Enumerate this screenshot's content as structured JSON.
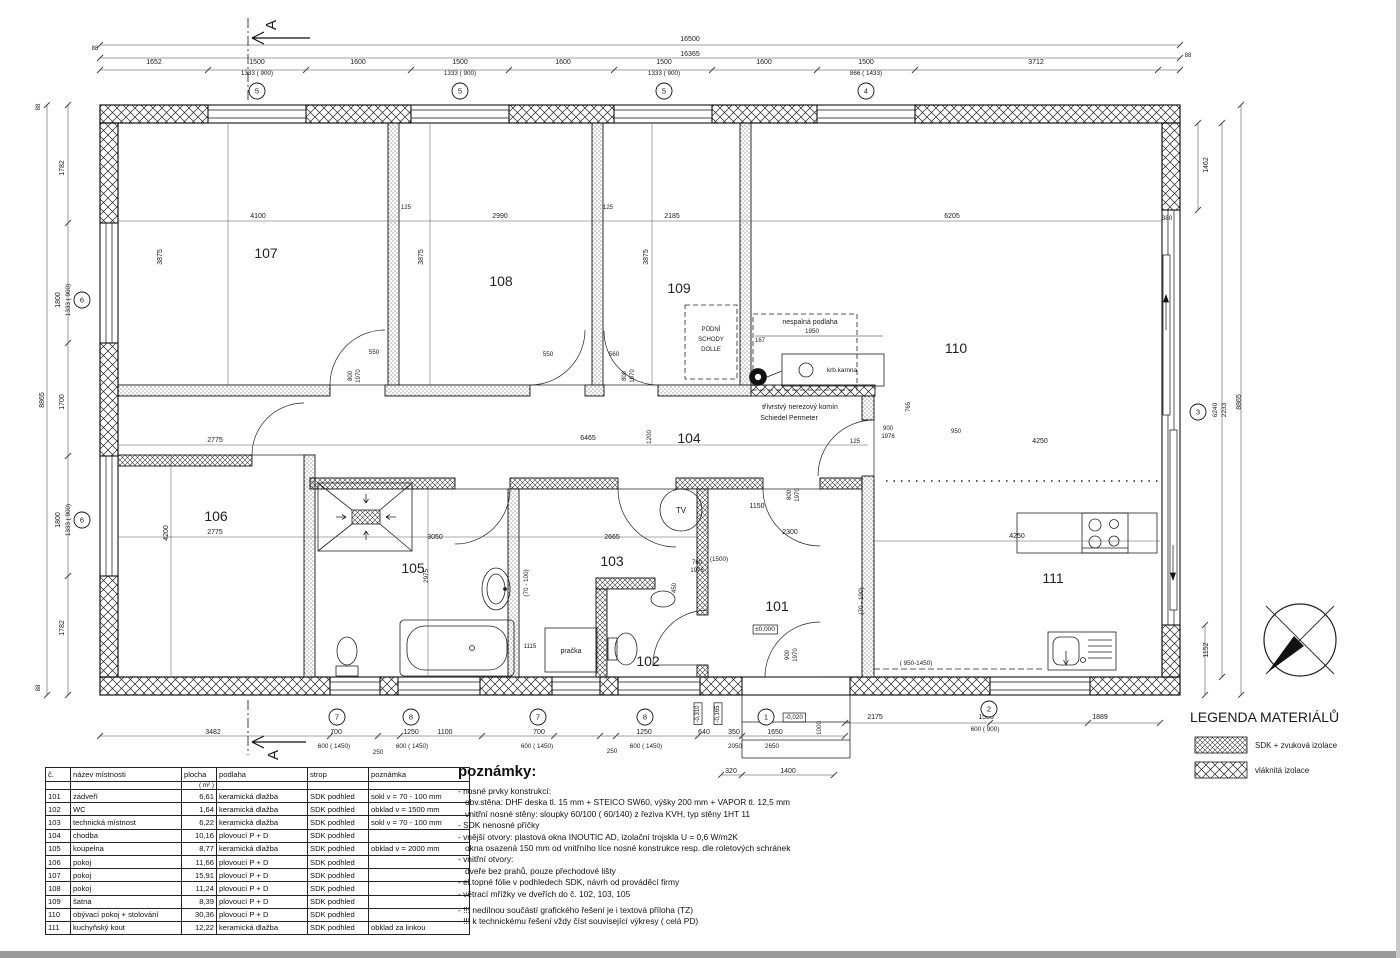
{
  "legend": {
    "title": "LEGENDA MATERIÁLŮ",
    "items": [
      {
        "label": "SDK + zvuková izolace"
      },
      {
        "label": "vláknitá izolace"
      }
    ]
  },
  "section_marker": "A",
  "room_table": {
    "headers": [
      "č.",
      "název místnosti",
      "plocha",
      "podlaha",
      "strop",
      "poznámka"
    ],
    "unit_row": [
      "",
      "",
      "( m² )",
      "",
      "",
      ""
    ],
    "rows": [
      [
        "101",
        "zádveří",
        "6,61",
        "keramická dlažba",
        "SDK podhled",
        "sokl v = 70 - 100 mm"
      ],
      [
        "102",
        "WC",
        "1,64",
        "keramická dlažba",
        "SDK podhled",
        "obklad v = 1500 mm"
      ],
      [
        "103",
        "technická místnost",
        "6,22",
        "keramická dlažba",
        "SDK podhled",
        "sokl v = 70 - 100 mm"
      ],
      [
        "104",
        "chodba",
        "10,16",
        "plovoucí P + D",
        "SDK podhled",
        ""
      ],
      [
        "105",
        "koupelna",
        "8,77",
        "keramická dlažba",
        "SDK podhled",
        "obklad v = 2000 mm"
      ],
      [
        "106",
        "pokoj",
        "11,66",
        "plovoucí P + D",
        "SDK podhled",
        ""
      ],
      [
        "107",
        "pokoj",
        "15,91",
        "plovoucí P + D",
        "SDK podhled",
        ""
      ],
      [
        "108",
        "pokoj",
        "11,24",
        "plovoucí P + D",
        "SDK podhled",
        ""
      ],
      [
        "109",
        "šatna",
        "8,39",
        "plovoucí P + D",
        "SDK podhled",
        ""
      ],
      [
        "110",
        "obývací pokoj + stolování",
        "30,36",
        "plovoucí P + D",
        "SDK podhled",
        ""
      ],
      [
        "111",
        "kuchyňský kout",
        "12,22",
        "keramická dlažba",
        "SDK podhled",
        "obklad za linkou"
      ]
    ]
  },
  "notes": {
    "heading": "poznámky:",
    "lines": [
      {
        "text": "- nosné prvky konstrukcí:",
        "indent": false,
        "gap": false
      },
      {
        "text": "obv.stěna: DHF deska tl. 15 mm + STEICO SW60, výšky 200 mm + VAPOR tl. 12,5 mm",
        "indent": true,
        "gap": false
      },
      {
        "text": "vnitřní nosné stěny: sloupky 60/100  ( 60/140)   z řeziva KVH, typ stěny 1HT 11",
        "indent": true,
        "gap": false
      },
      {
        "text": "- SDK nenosné příčky",
        "indent": false,
        "gap": false
      },
      {
        "text": "- vnější otvory:  plastová okna INOUTIC AD, izolační trojskla U = 0,6 W/m2K",
        "indent": false,
        "gap": false
      },
      {
        "text": "okna osazená 150 mm od vnitřního líce nosné konstrukce resp. dle  roletových schránek",
        "indent": true,
        "gap": false
      },
      {
        "text": "- vnitřní otvory:",
        "indent": false,
        "gap": false
      },
      {
        "text": "dveře bez prahů, pouze přechodové lišty",
        "indent": true,
        "gap": false
      },
      {
        "text": "- el.topné fólie v podhledech SDK, návrh od prováděcí firmy",
        "indent": false,
        "gap": false
      },
      {
        "text": "- větrací mřížky ve dveřích do č. 102, 103, 105",
        "indent": false,
        "gap": false
      },
      {
        "text": "- !!!  nedílnou součástí grafického řešení je i textová příloha  (TZ)",
        "indent": false,
        "gap": true
      },
      {
        "text": "- !!! k technickému řešení vždy číst související výkresy  ( celá PD)",
        "indent": false,
        "gap": false
      }
    ]
  },
  "plan": {
    "rooms": [
      {
        "id": "101",
        "x": 777,
        "y": 611
      },
      {
        "id": "102",
        "x": 648,
        "y": 666
      },
      {
        "id": "103",
        "x": 612,
        "y": 566
      },
      {
        "id": "104",
        "x": 689,
        "y": 443
      },
      {
        "id": "105",
        "x": 413,
        "y": 573
      },
      {
        "id": "106",
        "x": 216,
        "y": 521
      },
      {
        "id": "107",
        "x": 266,
        "y": 258
      },
      {
        "id": "108",
        "x": 501,
        "y": 286
      },
      {
        "id": "109",
        "x": 679,
        "y": 293
      },
      {
        "id": "110",
        "x": 956,
        "y": 353
      },
      {
        "id": "111",
        "x": 1053,
        "y": 583
      }
    ],
    "bubbles": [
      {
        "n": "5",
        "x": 257,
        "y": 91
      },
      {
        "n": "5",
        "x": 460,
        "y": 91
      },
      {
        "n": "5",
        "x": 664,
        "y": 91
      },
      {
        "n": "4",
        "x": 866,
        "y": 91
      },
      {
        "n": "6",
        "x": 82,
        "y": 300
      },
      {
        "n": "6",
        "x": 82,
        "y": 520
      },
      {
        "n": "3",
        "x": 1198,
        "y": 412
      },
      {
        "n": "7",
        "x": 337,
        "y": 717
      },
      {
        "n": "8",
        "x": 411,
        "y": 717
      },
      {
        "n": "7",
        "x": 538,
        "y": 717
      },
      {
        "n": "8",
        "x": 645,
        "y": 717
      },
      {
        "n": "1",
        "x": 766,
        "y": 717
      },
      {
        "n": "2",
        "x": 989,
        "y": 709
      }
    ],
    "labels": [
      {
        "t": "16500",
        "x": 690,
        "y": 41
      },
      {
        "t": "16365",
        "x": 690,
        "y": 56
      },
      {
        "t": "1652",
        "x": 154,
        "y": 64
      },
      {
        "t": "1500",
        "x": 257,
        "y": 64
      },
      {
        "t": "1600",
        "x": 358,
        "y": 64
      },
      {
        "t": "1500",
        "x": 460,
        "y": 64
      },
      {
        "t": "1600",
        "x": 563,
        "y": 64
      },
      {
        "t": "1500",
        "x": 664,
        "y": 64
      },
      {
        "t": "1600",
        "x": 764,
        "y": 64
      },
      {
        "t": "1500",
        "x": 866,
        "y": 64
      },
      {
        "t": "3712",
        "x": 1036,
        "y": 64
      },
      {
        "t": "1333 ( 900)",
        "x": 257,
        "y": 75,
        "s": 6.3
      },
      {
        "t": "1333 ( 900)",
        "x": 460,
        "y": 75,
        "s": 6.3
      },
      {
        "t": "1333 ( 900)",
        "x": 664,
        "y": 75,
        "s": 6.3
      },
      {
        "t": "866 ( 1433)",
        "x": 866,
        "y": 75,
        "s": 6.3
      },
      {
        "t": "88",
        "x": 95,
        "y": 50,
        "s": 6
      },
      {
        "t": "88",
        "x": 1188,
        "y": 57,
        "s": 6
      },
      {
        "t": "8865",
        "x": 44,
        "y": 400,
        "r": 1
      },
      {
        "t": "1782",
        "x": 64,
        "y": 168,
        "r": 1
      },
      {
        "t": "1800",
        "x": 60,
        "y": 300,
        "r": 1
      },
      {
        "t": "1333 ( 900)",
        "x": 70,
        "y": 300,
        "r": 1,
        "s": 6.3
      },
      {
        "t": "1700",
        "x": 64,
        "y": 402,
        "r": 1
      },
      {
        "t": "1800",
        "x": 60,
        "y": 520,
        "r": 1
      },
      {
        "t": "1333 ( 900)",
        "x": 70,
        "y": 520,
        "r": 1,
        "s": 6.3
      },
      {
        "t": "1782",
        "x": 64,
        "y": 628,
        "r": 1
      },
      {
        "t": "88",
        "x": 40,
        "y": 107,
        "r": 1,
        "s": 6
      },
      {
        "t": "88",
        "x": 40,
        "y": 688,
        "r": 1,
        "s": 6
      },
      {
        "t": "1462",
        "x": 1208,
        "y": 165,
        "r": 1
      },
      {
        "t": "380",
        "x": 1167,
        "y": 220,
        "s": 6.3
      },
      {
        "t": "6240",
        "x": 1217,
        "y": 410,
        "r": 1,
        "s": 6.5
      },
      {
        "t": "2233",
        "x": 1226,
        "y": 410,
        "r": 1,
        "s": 6.5
      },
      {
        "t": "8865",
        "x": 1241,
        "y": 402,
        "r": 1
      },
      {
        "t": "1152",
        "x": 1208,
        "y": 650,
        "r": 1
      },
      {
        "t": "3482",
        "x": 213,
        "y": 734
      },
      {
        "t": "700",
        "x": 336,
        "y": 734
      },
      {
        "t": "1250",
        "x": 411,
        "y": 734
      },
      {
        "t": "1100",
        "x": 445,
        "y": 734
      },
      {
        "t": "700",
        "x": 539,
        "y": 734
      },
      {
        "t": "1250",
        "x": 644,
        "y": 734
      },
      {
        "t": "640",
        "x": 704,
        "y": 734
      },
      {
        "t": "350",
        "x": 734,
        "y": 734
      },
      {
        "t": "1650",
        "x": 775,
        "y": 734
      },
      {
        "t": "600 ( 1450)",
        "x": 334,
        "y": 748,
        "s": 6.3
      },
      {
        "t": "250",
        "x": 378,
        "y": 754,
        "s": 6.3
      },
      {
        "t": "600 ( 1450)",
        "x": 412,
        "y": 748,
        "s": 6.3
      },
      {
        "t": "600 ( 1450)",
        "x": 537,
        "y": 748,
        "s": 6.3
      },
      {
        "t": "250",
        "x": 612,
        "y": 753,
        "s": 6.3
      },
      {
        "t": "600 ( 1450)",
        "x": 646,
        "y": 748,
        "s": 6.3
      },
      {
        "t": "2050",
        "x": 735,
        "y": 748,
        "s": 6.3
      },
      {
        "t": "2650",
        "x": 772,
        "y": 748,
        "s": 6.3
      },
      {
        "t": "320",
        "x": 731,
        "y": 773
      },
      {
        "t": "1400",
        "x": 788,
        "y": 773
      },
      {
        "t": "-0,310",
        "x": 699,
        "y": 714,
        "r": 1,
        "b": 1,
        "s": 6
      },
      {
        "t": "-0,165",
        "x": 719,
        "y": 714,
        "r": 1,
        "b": 1,
        "s": 6
      },
      {
        "t": "-0,020",
        "x": 794,
        "y": 719,
        "b": 1,
        "s": 6.3
      },
      {
        "t": "1000",
        "x": 821,
        "y": 728,
        "r": 1,
        "s": 6.3
      },
      {
        "t": "2175",
        "x": 875,
        "y": 719
      },
      {
        "t": "1500",
        "x": 986,
        "y": 719
      },
      {
        "t": "600 ( 900)",
        "x": 985,
        "y": 731,
        "s": 6.3
      },
      {
        "t": "1889",
        "x": 1100,
        "y": 719
      },
      {
        "t": "4100",
        "x": 258,
        "y": 218
      },
      {
        "t": "2990",
        "x": 500,
        "y": 218
      },
      {
        "t": "2185",
        "x": 672,
        "y": 218
      },
      {
        "t": "6205",
        "x": 952,
        "y": 218
      },
      {
        "t": "3875",
        "x": 162,
        "y": 257,
        "r": 1
      },
      {
        "t": "3875",
        "x": 423,
        "y": 257,
        "r": 1
      },
      {
        "t": "3875",
        "x": 648,
        "y": 257,
        "r": 1
      },
      {
        "t": "125",
        "x": 406,
        "y": 209,
        "s": 6
      },
      {
        "t": "125",
        "x": 608,
        "y": 209,
        "s": 6
      },
      {
        "t": "2775",
        "x": 215,
        "y": 442
      },
      {
        "t": "6465",
        "x": 588,
        "y": 440
      },
      {
        "t": "1200",
        "x": 651,
        "y": 437,
        "r": 1,
        "s": 6.3
      },
      {
        "t": "125",
        "x": 855,
        "y": 443,
        "s": 6
      },
      {
        "t": "900",
        "x": 888,
        "y": 430,
        "s": 6
      },
      {
        "t": "1976",
        "x": 888,
        "y": 438,
        "s": 6
      },
      {
        "t": "4250",
        "x": 1040,
        "y": 443
      },
      {
        "t": "2775",
        "x": 215,
        "y": 534
      },
      {
        "t": "4200",
        "x": 168,
        "y": 533,
        "r": 1
      },
      {
        "t": "3050",
        "x": 435,
        "y": 539
      },
      {
        "t": "2975",
        "x": 428,
        "y": 576,
        "r": 1,
        "s": 6.3
      },
      {
        "t": "2665",
        "x": 612,
        "y": 539
      },
      {
        "t": "2300",
        "x": 790,
        "y": 534
      },
      {
        "t": "1150",
        "x": 757,
        "y": 508
      },
      {
        "t": "4250",
        "x": 1017,
        "y": 538
      },
      {
        "t": "(70 - 100)",
        "x": 528,
        "y": 583,
        "r": 1,
        "s": 6.3
      },
      {
        "t": "(70 - 100)",
        "x": 863,
        "y": 601,
        "r": 1,
        "s": 6.3
      },
      {
        "t": "( 950-1450)",
        "x": 916,
        "y": 665,
        "s": 6.3
      },
      {
        "t": "(1500)",
        "x": 719,
        "y": 561,
        "s": 6.3
      },
      {
        "t": "550",
        "x": 374,
        "y": 354,
        "s": 6.3
      },
      {
        "t": "800",
        "x": 352,
        "y": 376,
        "r": 1,
        "s": 6
      },
      {
        "t": "1970",
        "x": 360,
        "y": 376,
        "r": 1,
        "s": 6
      },
      {
        "t": "550",
        "x": 548,
        "y": 356,
        "s": 6.3
      },
      {
        "t": "560",
        "x": 614,
        "y": 356,
        "s": 6.3
      },
      {
        "t": "800",
        "x": 626,
        "y": 376,
        "r": 1,
        "s": 6
      },
      {
        "t": "1970",
        "x": 634,
        "y": 376,
        "r": 1,
        "s": 6
      },
      {
        "t": "760",
        "x": 697,
        "y": 564,
        "s": 6
      },
      {
        "t": "1976",
        "x": 697,
        "y": 572,
        "s": 6
      },
      {
        "t": "450",
        "x": 676,
        "y": 588,
        "r": 1,
        "s": 6
      },
      {
        "t": "800",
        "x": 791,
        "y": 495,
        "r": 1,
        "s": 6
      },
      {
        "t": "1970",
        "x": 799,
        "y": 495,
        "r": 1,
        "s": 6
      },
      {
        "t": "900",
        "x": 789,
        "y": 655,
        "r": 1,
        "s": 6
      },
      {
        "t": "1970",
        "x": 797,
        "y": 655,
        "r": 1,
        "s": 6
      },
      {
        "t": "167",
        "x": 760,
        "y": 342,
        "s": 6
      },
      {
        "t": "765",
        "x": 910,
        "y": 407,
        "r": 1,
        "s": 6
      },
      {
        "t": "950",
        "x": 956,
        "y": 433,
        "s": 6
      },
      {
        "t": "1950",
        "x": 812,
        "y": 333,
        "s": 6.3
      },
      {
        "t": "1115",
        "x": 530,
        "y": 648,
        "s": 6
      },
      {
        "t": "nespalná podlaha",
        "x": 810,
        "y": 324,
        "c": "ann"
      },
      {
        "t": "třívrstvý nerezový komín",
        "x": 800,
        "y": 409,
        "c": "ann"
      },
      {
        "t": "Schiedel Permeter",
        "x": 789,
        "y": 420,
        "c": "ann"
      },
      {
        "t": "krb.kamna",
        "x": 842,
        "y": 372,
        "s": 6.5
      },
      {
        "t": "PŮDNÍ",
        "x": 711,
        "y": 331,
        "s": 6
      },
      {
        "t": "SCHODY",
        "x": 711,
        "y": 341,
        "s": 6
      },
      {
        "t": "DOLLE",
        "x": 711,
        "y": 351,
        "s": 6
      },
      {
        "t": "pračka",
        "x": 571,
        "y": 653,
        "s": 7
      },
      {
        "t": "TV",
        "x": 681,
        "y": 513,
        "s": 8
      },
      {
        "t": "±0,000",
        "x": 765,
        "y": 631,
        "b": 1,
        "s": 6.5
      }
    ]
  }
}
